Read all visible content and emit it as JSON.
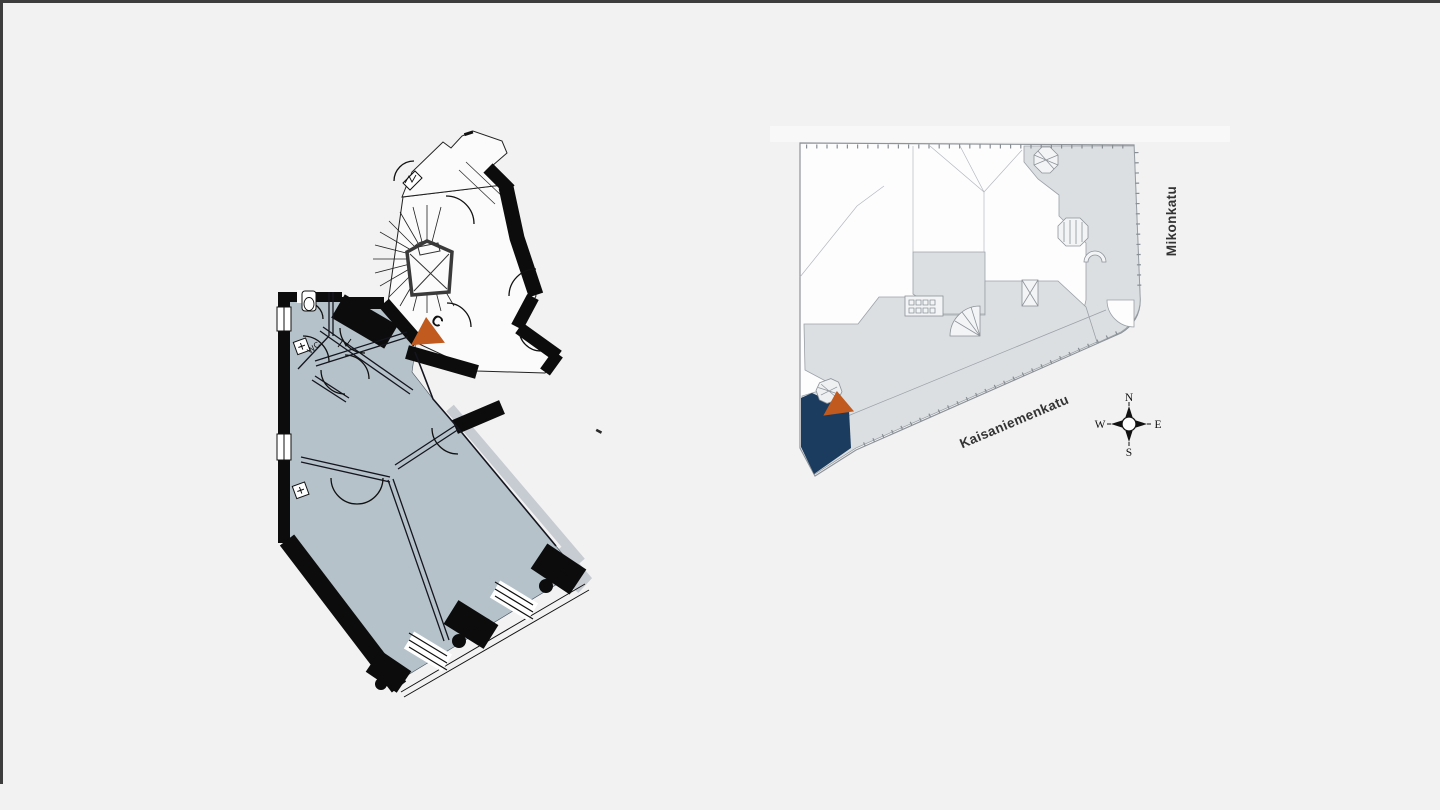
{
  "page": {
    "background_color": "#f2f2f3",
    "frame_border_color": "#3d3d3d"
  },
  "floor_plan": {
    "description": "apartment floor plan, rotated footprint with stair hall",
    "stairwell_label": "C",
    "wc_label": "WC",
    "room_fill_color": "#b5c2ca",
    "wall_color": "#0c0c0c",
    "marker_color": "#c05a1e"
  },
  "site_plan": {
    "description": "building block overview with highlighted unit",
    "building_fill_color": "#dcdfe2",
    "outline_color": "#8d9399",
    "highlight_fill_color": "#1b3c5f",
    "marker_color": "#c05a1e",
    "streets": [
      {
        "label": "Kaisaniemenkatu"
      },
      {
        "label": "Mikonkatu"
      }
    ]
  },
  "compass": {
    "north": "N",
    "east": "E",
    "south": "S",
    "west": "W"
  }
}
